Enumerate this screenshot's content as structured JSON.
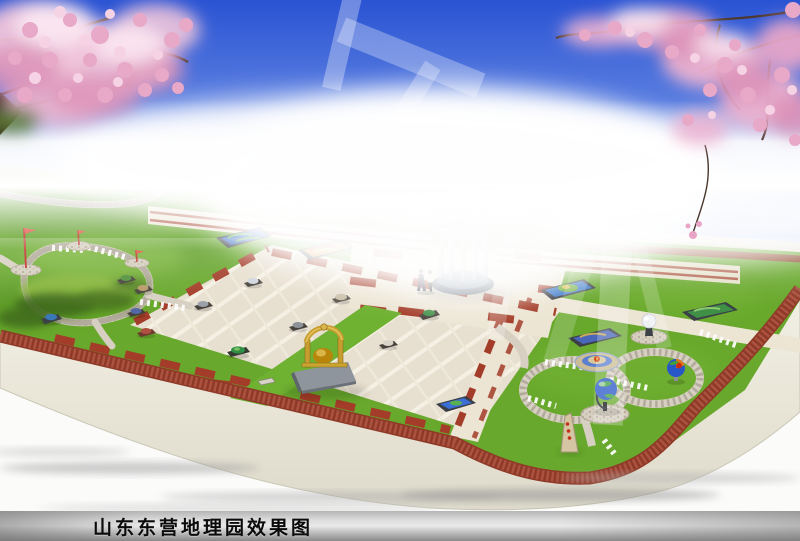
{
  "caption": {
    "text": "山东东营地理园效果图"
  },
  "palette": {
    "sky_top": "#2a53d3",
    "sky_mid": "#7e9ce8",
    "horizon_fog": "#ffffff",
    "lawn": "#68a82c",
    "road_brick": "#9c4030",
    "plaza_paving": "#e7dfcf",
    "platform_edge": "#e9e6d8",
    "blossom_pink": "#eeb7d2",
    "dome_segments": [
      "#223a7a",
      "#b8402e",
      "#3f8a3a",
      "#c49858",
      "#e8dfc8"
    ],
    "caption_text": "#0b0b0b"
  },
  "scene_objects": {
    "dome_pavilion": "globe-dome-pavilion",
    "golden_sculpture": "seismoscope-sculpture",
    "globe_model": "terrestrial-globe-on-stand",
    "earth_cutaway_model": "earth-cutaway-globe",
    "volcano_model": "volcano-relief-oval",
    "white_sphere_monument": "sphere-on-pedestal",
    "stone_stele": "stone-marker",
    "map_panel_count": 6,
    "flag_pole_count": 3,
    "visitor_count": 2,
    "cherry_trees": [
      "top-left",
      "top-right"
    ]
  }
}
